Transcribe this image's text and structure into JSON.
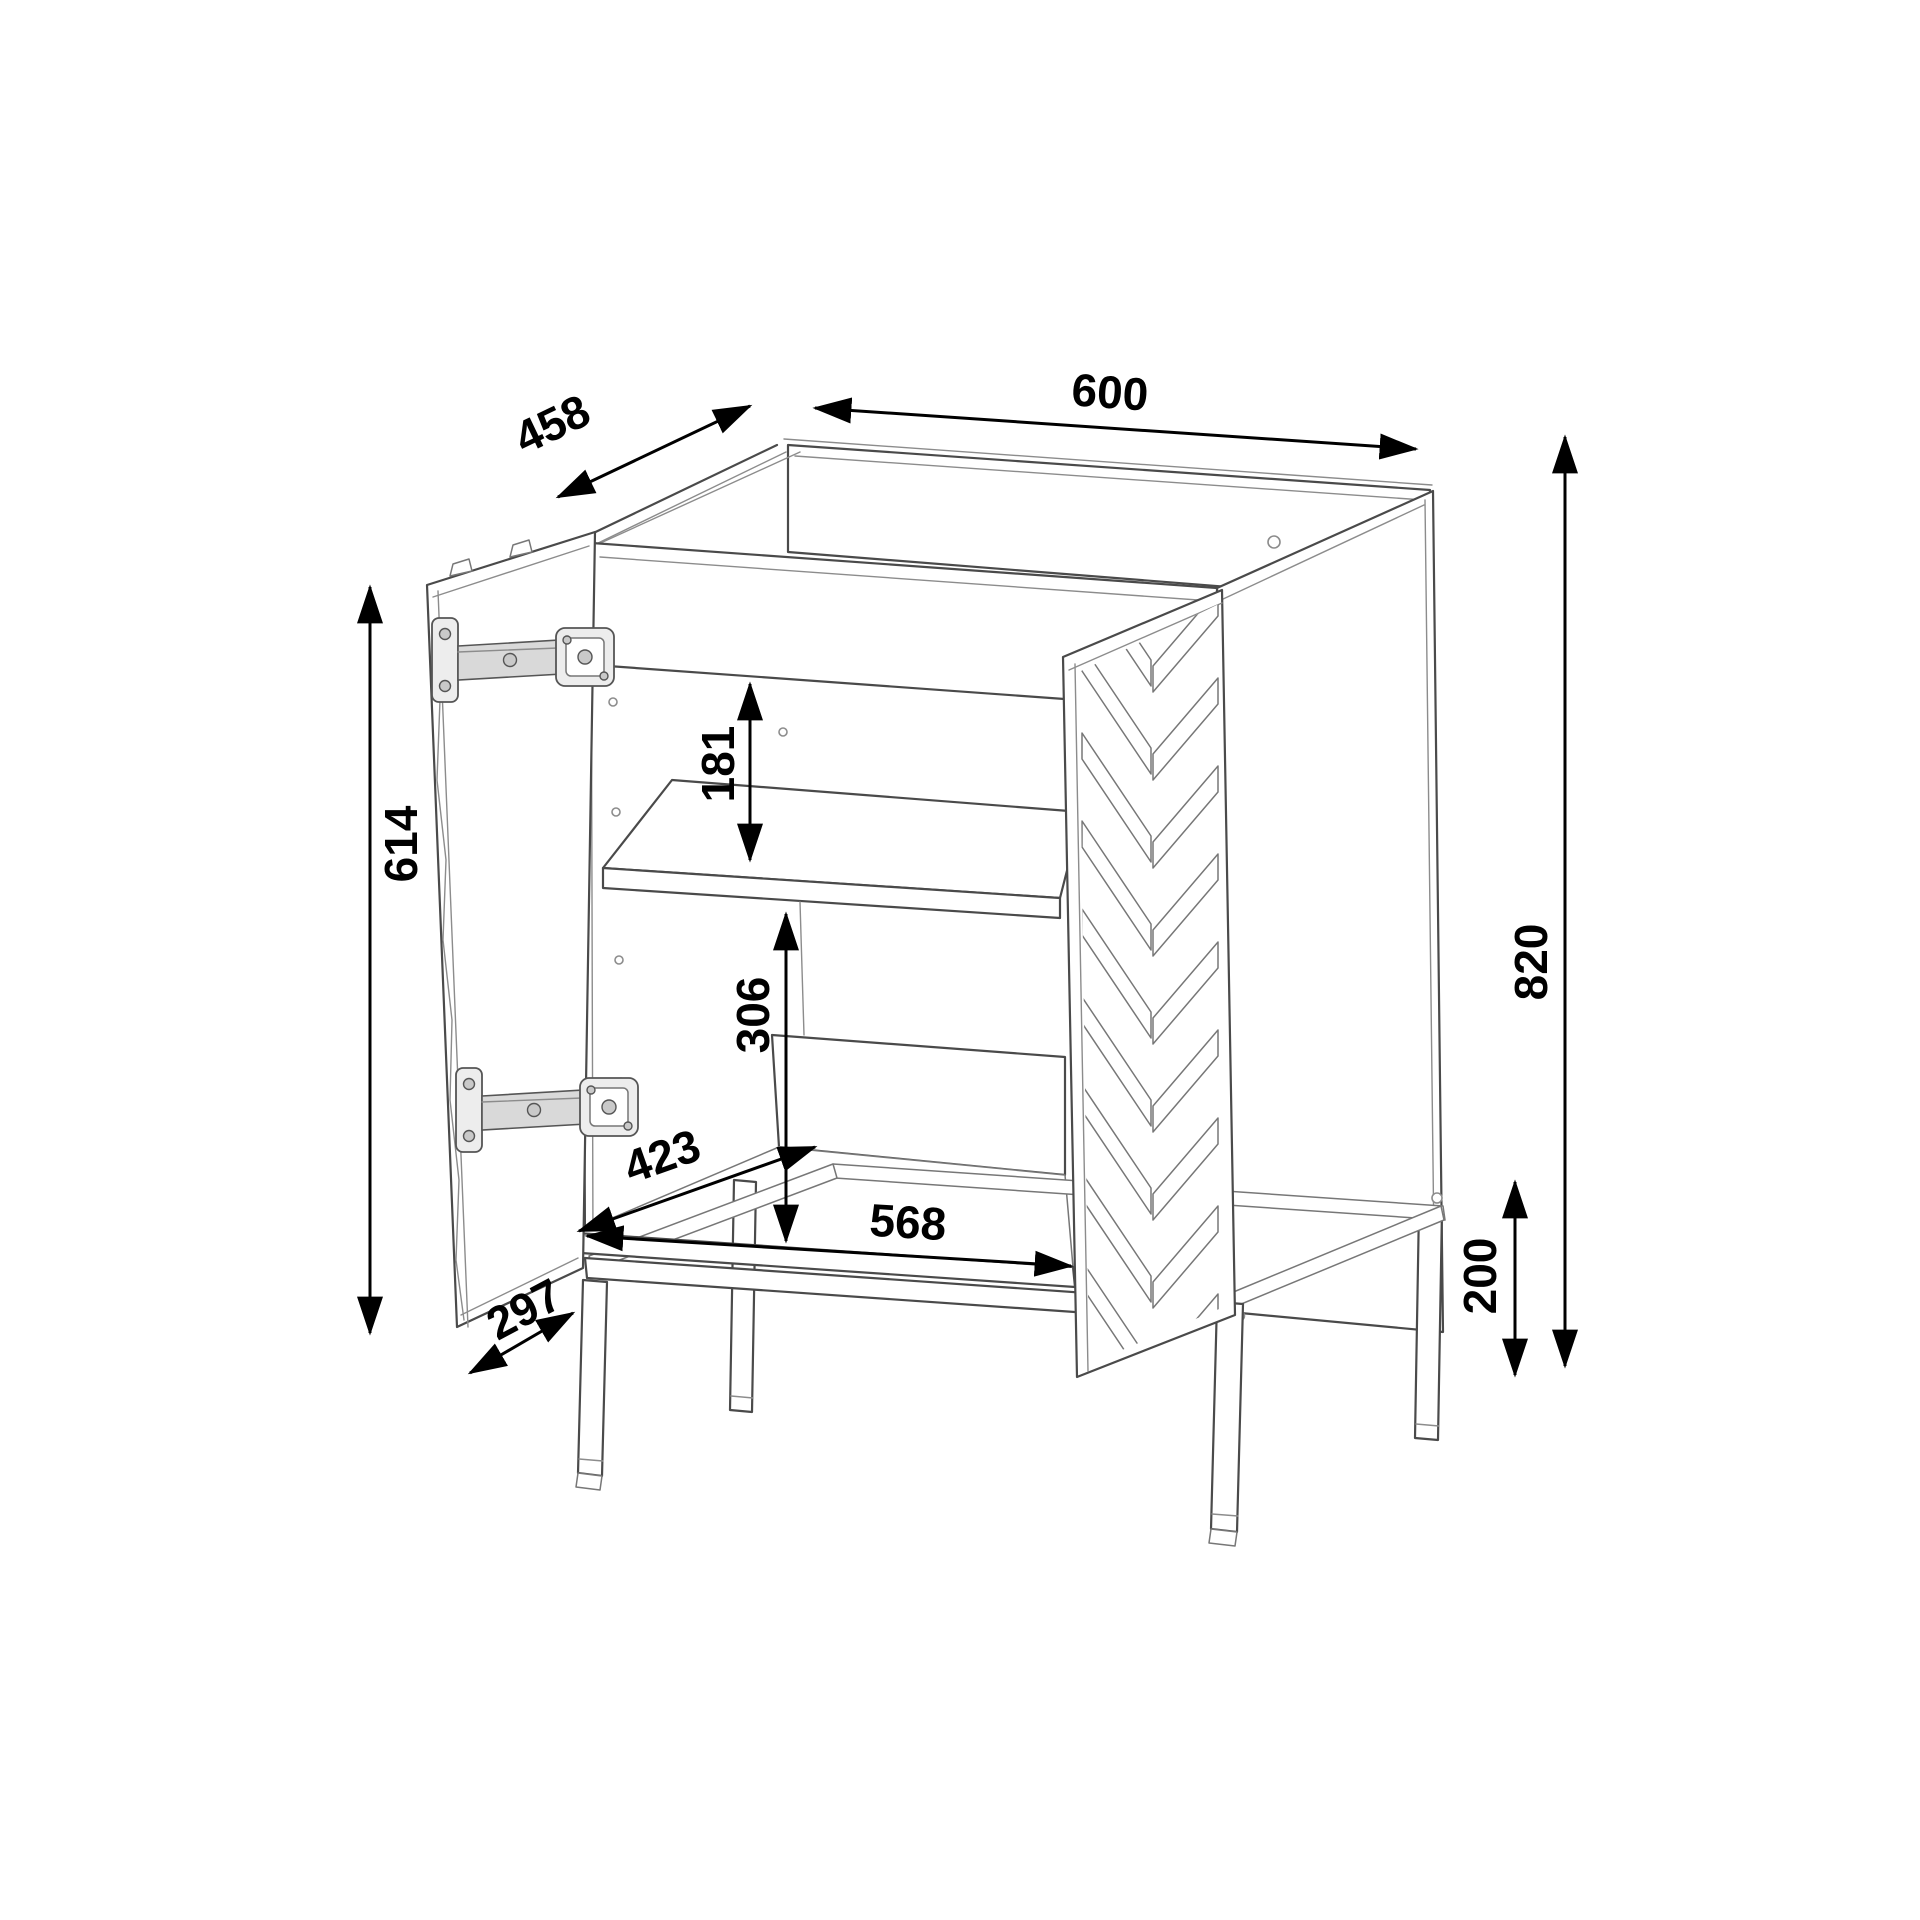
{
  "drawing": {
    "object": "two-door cabinet technical drawing, left door open with hinges, right door with chevron pattern, interior shelf and metal leg frame",
    "background": "#ffffff",
    "line_color": "#4a4a4a",
    "dimension_color": "#000000"
  },
  "dimensions": {
    "overall_width": {
      "value": "600"
    },
    "overall_depth": {
      "value": "458"
    },
    "carcass_height": {
      "value": "820"
    },
    "door_height": {
      "value": "614"
    },
    "upper_gap": {
      "value": "181"
    },
    "lower_gap": {
      "value": "306"
    },
    "interior_depth": {
      "value": "423"
    },
    "interior_width": {
      "value": "568"
    },
    "door_width": {
      "value": "297"
    },
    "leg_height": {
      "value": "200"
    }
  }
}
